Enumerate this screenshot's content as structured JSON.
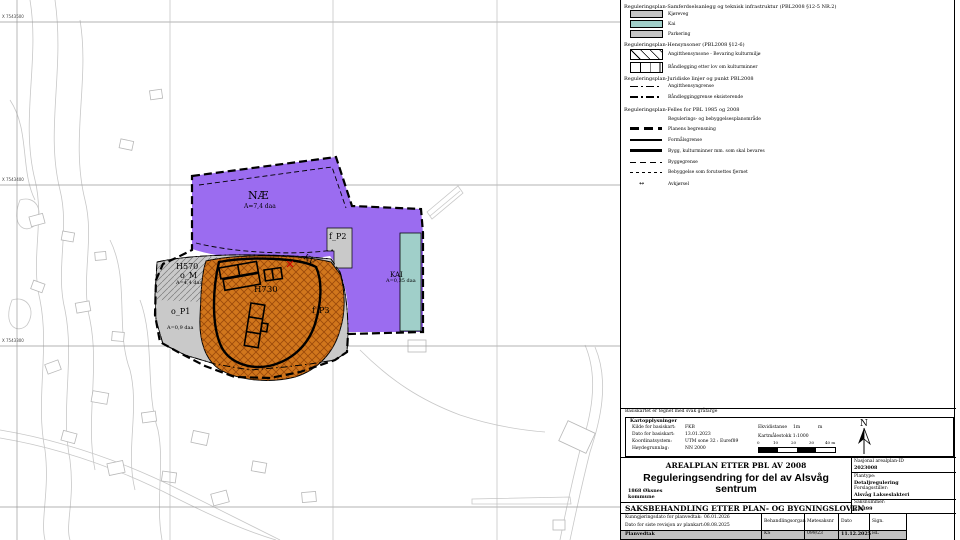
{
  "map": {
    "grid_labels": [
      {
        "text": "X 7543500"
      },
      {
        "text": "X 7543400"
      },
      {
        "text": "X 7543300"
      }
    ],
    "zones": {
      "nae": {
        "label": "NÆ",
        "area": "A=7,4 daa"
      },
      "f_p2": {
        "label": "f_P2"
      },
      "f_p3": {
        "label": "f_P3"
      },
      "kv": {
        "label": "KV"
      },
      "kai": {
        "label": "KAI",
        "area": "A=0,35 daa"
      },
      "h570": {
        "label": "H570",
        "sub": "o_M",
        "area": "A=4,4 daa"
      },
      "h730": {
        "label": "H730"
      },
      "o_p1": {
        "label": "o_P1",
        "area": "A=0,9 daa"
      }
    },
    "colors": {
      "purple": "#9b6cf0",
      "orange": "#d1761c",
      "teal": "#a0cfc9",
      "zone_gray": "#c9c9c9"
    }
  },
  "legend": {
    "sections": [
      {
        "heading": "Reguleringsplan-Samferdselsanlegg og teknisk infrastruktur (PBL2008 §12-5 NR.2)",
        "items": [
          {
            "label": "Kjøreveg"
          },
          {
            "label": "Kai"
          },
          {
            "label": "Parkering"
          }
        ]
      },
      {
        "heading": "Reguleringsplan-Hensynsoner (PBL2008 §12-6)",
        "items": [
          {
            "label": "Angitthensynsone - Bevaring kulturmiljø"
          },
          {
            "label": "Båndlegging etter lov om kulturminner"
          }
        ]
      },
      {
        "heading": "Reguleringsplan-Juridiske linjer og punkt PBL2008",
        "items": [
          {
            "label": "Angitthensyngrense"
          },
          {
            "label": "Båndlegginggrense eksisterende"
          }
        ]
      },
      {
        "heading": "Reguleringsplan-Felles for  PBL 1985 og 2008",
        "items": [
          {
            "label": "Regulerings- og bebyggelsesplanområde"
          },
          {
            "label": "Planens begrensning"
          },
          {
            "label": "Formålsgrense"
          },
          {
            "label": "Bygg, kulturminner mm. som skal bevares"
          },
          {
            "label": "Byggegrense"
          },
          {
            "label": "Bebyggelse som forutsettes fjernet"
          },
          {
            "label": "Avkjørsel"
          }
        ]
      }
    ],
    "arrow_glyph": "↔"
  },
  "basemap_note": "Basiskartet er tegnet med svak gråfarge",
  "map_info": {
    "heading": "Kartopplysninger",
    "rows": [
      {
        "label": "Kilde for basiskart:",
        "value": "FKB"
      },
      {
        "label": "Dato for basiskart:",
        "value": "13.01.2023"
      },
      {
        "label": "Koordinatsystem:",
        "value": "UTM sone 32 : Euref89"
      },
      {
        "label": "Høydegrunnlag:",
        "value": "NN 2000"
      }
    ],
    "ekvidistanse_label": "Ekvidistanse",
    "ekvidistanse_value": "1m",
    "ekvidistanse_unit": "m",
    "scale_label": "Kartmålestokk 1:1000",
    "scalebar_ticks": [
      "0",
      "10",
      "20",
      "30",
      "40 m"
    ],
    "north_letter": "N"
  },
  "title_block": {
    "law_title": "AREALPLAN ETTER PBL AV 2008",
    "plan_title": "Reguleringsendring for del av Alsvåg sentrum",
    "municipality": "1868 Øksnes kommune",
    "processing_title": "SAKSBEHANDLING ETTER PLAN- OG BYGNINGSLOVEN",
    "plan_id_label": "Nasjonal arealplan-ID",
    "plan_id": "2023008",
    "plantype_label": "Plantype:",
    "plantype": "Detaljregulering",
    "proposer_label": "Forslagsstiller:",
    "proposer": "Alsvåg Lakseslakteri",
    "case_label": "Saksnummer:",
    "case_number": "23/399",
    "announce_label": "Kunngjøringsdato for planvedtak:",
    "announce_date": "06.01.2026",
    "revision_label": "Dato for siste revisjon av plankart:",
    "revision_date": "08.08.2025",
    "col_headers": [
      "Behandlingsorgan",
      "Møtesaksnr",
      "Dato",
      "Sign."
    ],
    "decision_row": {
      "label": "Planvedtak",
      "organ": "KS",
      "case": "099/23",
      "date": "11.12.2025",
      "sign": "HL"
    }
  }
}
